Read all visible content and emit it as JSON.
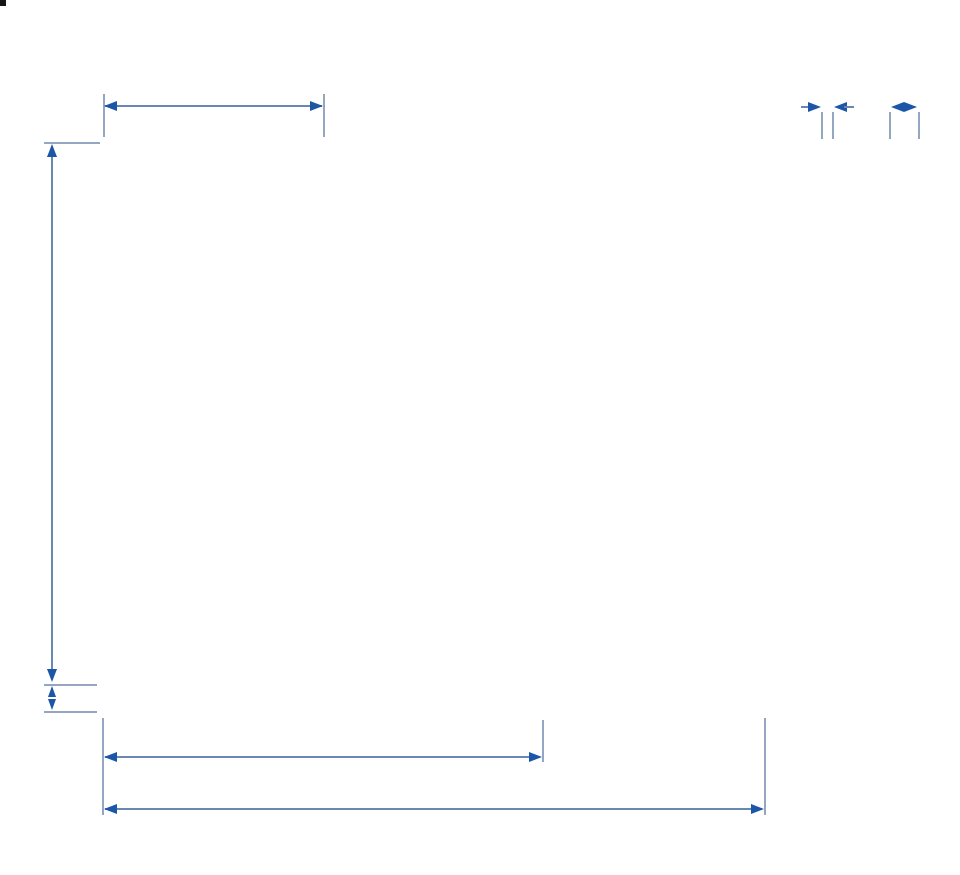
{
  "page": {
    "description": "Shelving unit / room divider measurement diagram, front view with three sections plus two side profile views"
  },
  "colors": {
    "label_text": "#1b55a4",
    "arrowhead": "#1c56a6",
    "dimension_line": "#6887b2",
    "extension_line": "#94a6c0",
    "furniture_line": "#161616",
    "background": "#ffffff"
  },
  "dimensions": {
    "section_width": "72 cm (28 ⅜\")",
    "panel_thickness_line1": "3 cm",
    "panel_thickness_line2": "(⅛\")",
    "depth_line1": "9 cm",
    "depth_line2": "(3 ½\")",
    "height": "176 cm (69 ¼\")",
    "leg_height": "9 cm (3 ½\")",
    "two_sections_width": "144 cm (56 ¾\")",
    "total_width": "216 cm (85\")"
  },
  "diagram": {
    "front_view": {
      "left": 103,
      "top": 141,
      "width": 664,
      "height": 572,
      "sections": 3,
      "stile_width": 13,
      "shelf_thickness": 15,
      "shelf_tops": [
        0,
        99,
        269,
        437,
        532
      ],
      "rows": [
        {
          "top": 15,
          "bottom": 99,
          "dividers": [
            0.33,
            0.66,
            0.33
          ]
        },
        {
          "top": 114,
          "bottom": 269,
          "dividers": [
            0.66,
            0.33,
            0.66
          ]
        },
        {
          "top": 284,
          "bottom": 437,
          "dividers": [
            0.33,
            0.66,
            0.33
          ]
        },
        {
          "top": 452,
          "bottom": 532,
          "dividers": [
            0.66,
            0.33,
            0.66
          ]
        }
      ],
      "divider_width": 9
    },
    "side_views": {
      "thin_panel": {
        "left": 821,
        "top": 141,
        "width": 13,
        "height": 572
      },
      "deep_panel": {
        "left": 888,
        "top": 141,
        "width": 33,
        "height": 572,
        "inner_lines": [
          11,
          20
        ]
      }
    }
  }
}
